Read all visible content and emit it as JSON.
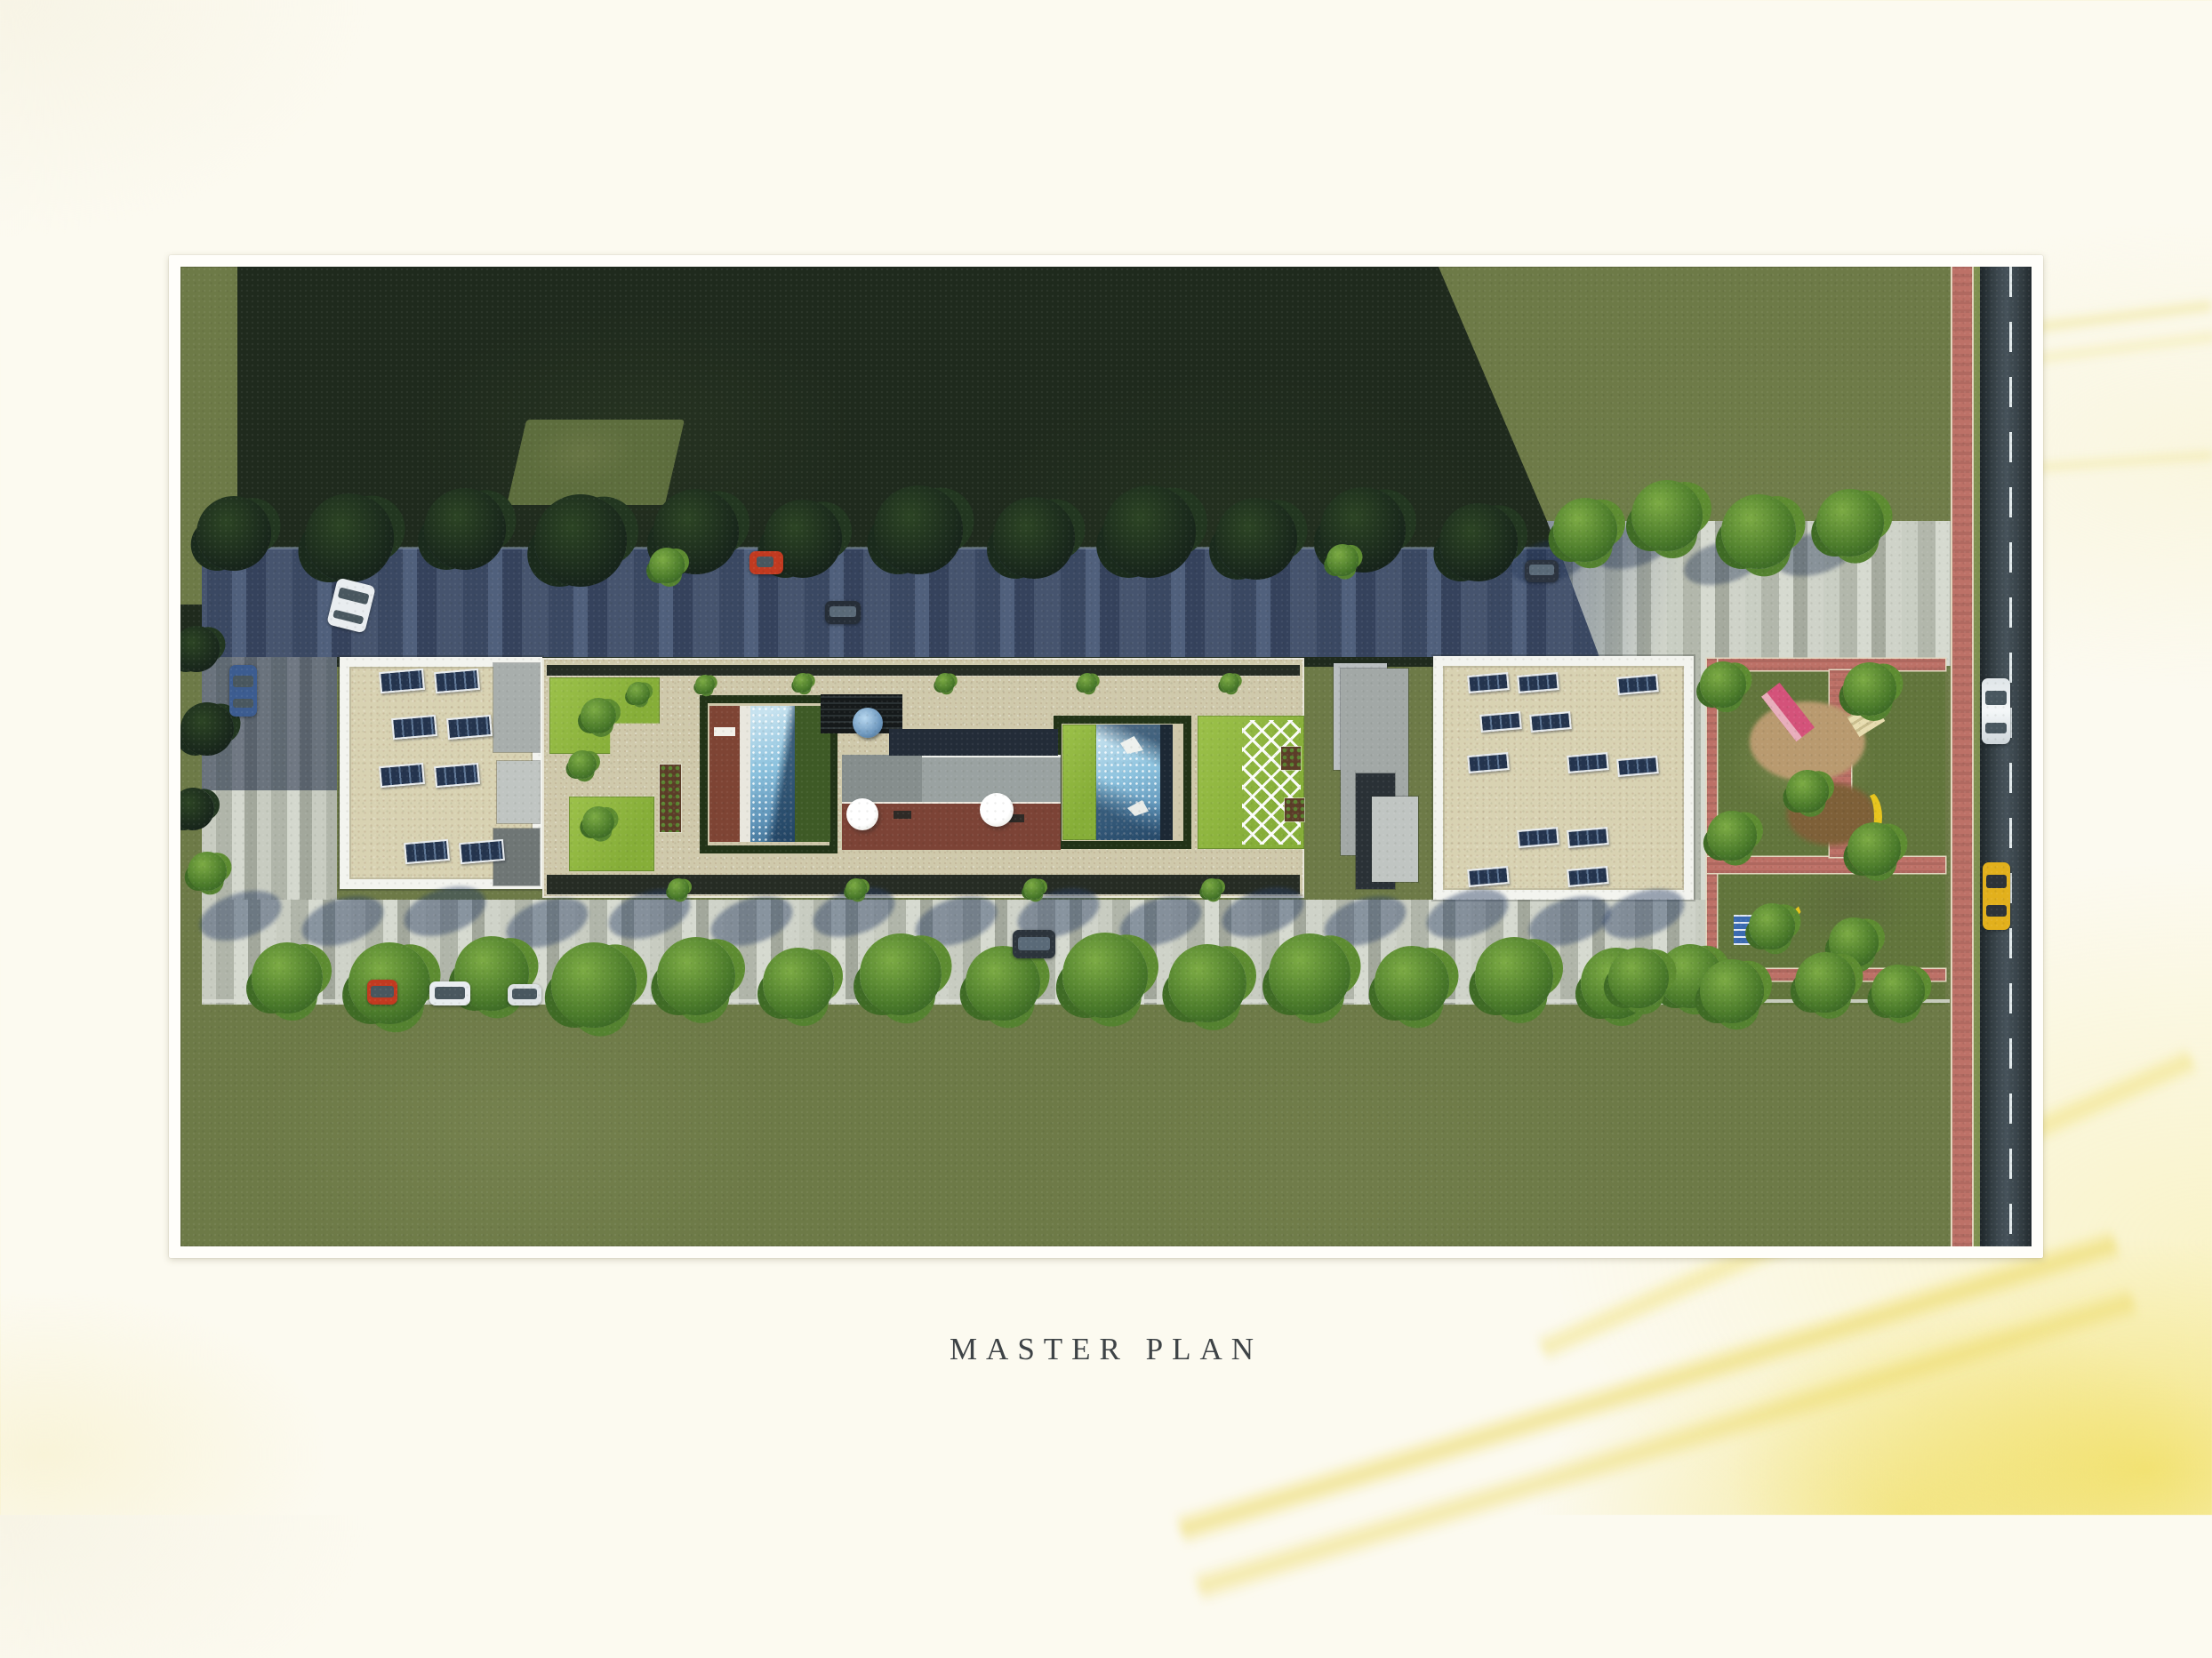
{
  "caption": {
    "text": "MASTER PLAN"
  },
  "photo": {
    "alt": "Aerial top-down architectural rendering of a linear residential complex master plan",
    "frame_color": "#fffefa"
  },
  "scene": {
    "site_features": [
      "sunlit lawn surrounding site",
      "large building shadow across upper-left lawn",
      "shaded parking driveway along north side of complex",
      "two white apartment blocks with rooftop solar panels",
      "central landscaped courtyard with two swimming pools",
      "wood pool deck and roof terrace with white umbrellas",
      "blue-domed pavilion and pergola",
      "diagonal white paver lattice on lawn",
      "striped pedestrian walkway and plaza",
      "tree-lined promenade with parked cars",
      "children playground with red brick paths",
      "red brick footpath along road",
      "two-lane asphalt road with dashed center line"
    ],
    "vehicles": [
      {
        "label": "white car parked in north driveway",
        "color": "#e9edf0"
      },
      {
        "label": "blue car parked at west edge",
        "color": "#3c5c90"
      },
      {
        "label": "red car parked in north driveway",
        "color": "#c23a20"
      },
      {
        "label": "dark car parked in north driveway",
        "color": "#262e38"
      },
      {
        "label": "red car parked at south promenade",
        "color": "#c23a20"
      },
      {
        "label": "white cars parked at south promenade",
        "color": "#e9edf0"
      },
      {
        "label": "dark car parked at south walkway",
        "color": "#2c343c"
      },
      {
        "label": "white car driving on road",
        "color": "#e9edf0"
      },
      {
        "label": "yellow taxi driving on road",
        "color": "#e2b01c"
      }
    ],
    "playground_equipment": [
      {
        "label": "pink slide tower",
        "color": "#d4527a"
      },
      {
        "label": "yellow curved slides",
        "color": "#e8c51d"
      },
      {
        "label": "blue climbing panel",
        "color": "#3a6ab0"
      },
      {
        "label": "cream double bench",
        "color": "#e8ddb0"
      }
    ],
    "palette": {
      "sunlit_grass": "#6d7a47",
      "shadow_grass": "#1f2a1d",
      "pool_water": "#8cc2de",
      "roof_beige": "#d8d2b2",
      "parapet_white": "#f3f4ef",
      "red_path": "#bd7167",
      "road_asphalt": "#39444a",
      "walkway_stone": "#c8ccc1",
      "hedge_green": "#223317",
      "lawn_bright": "#8cb43d",
      "background_yellow_wash": "#eedc55"
    }
  }
}
